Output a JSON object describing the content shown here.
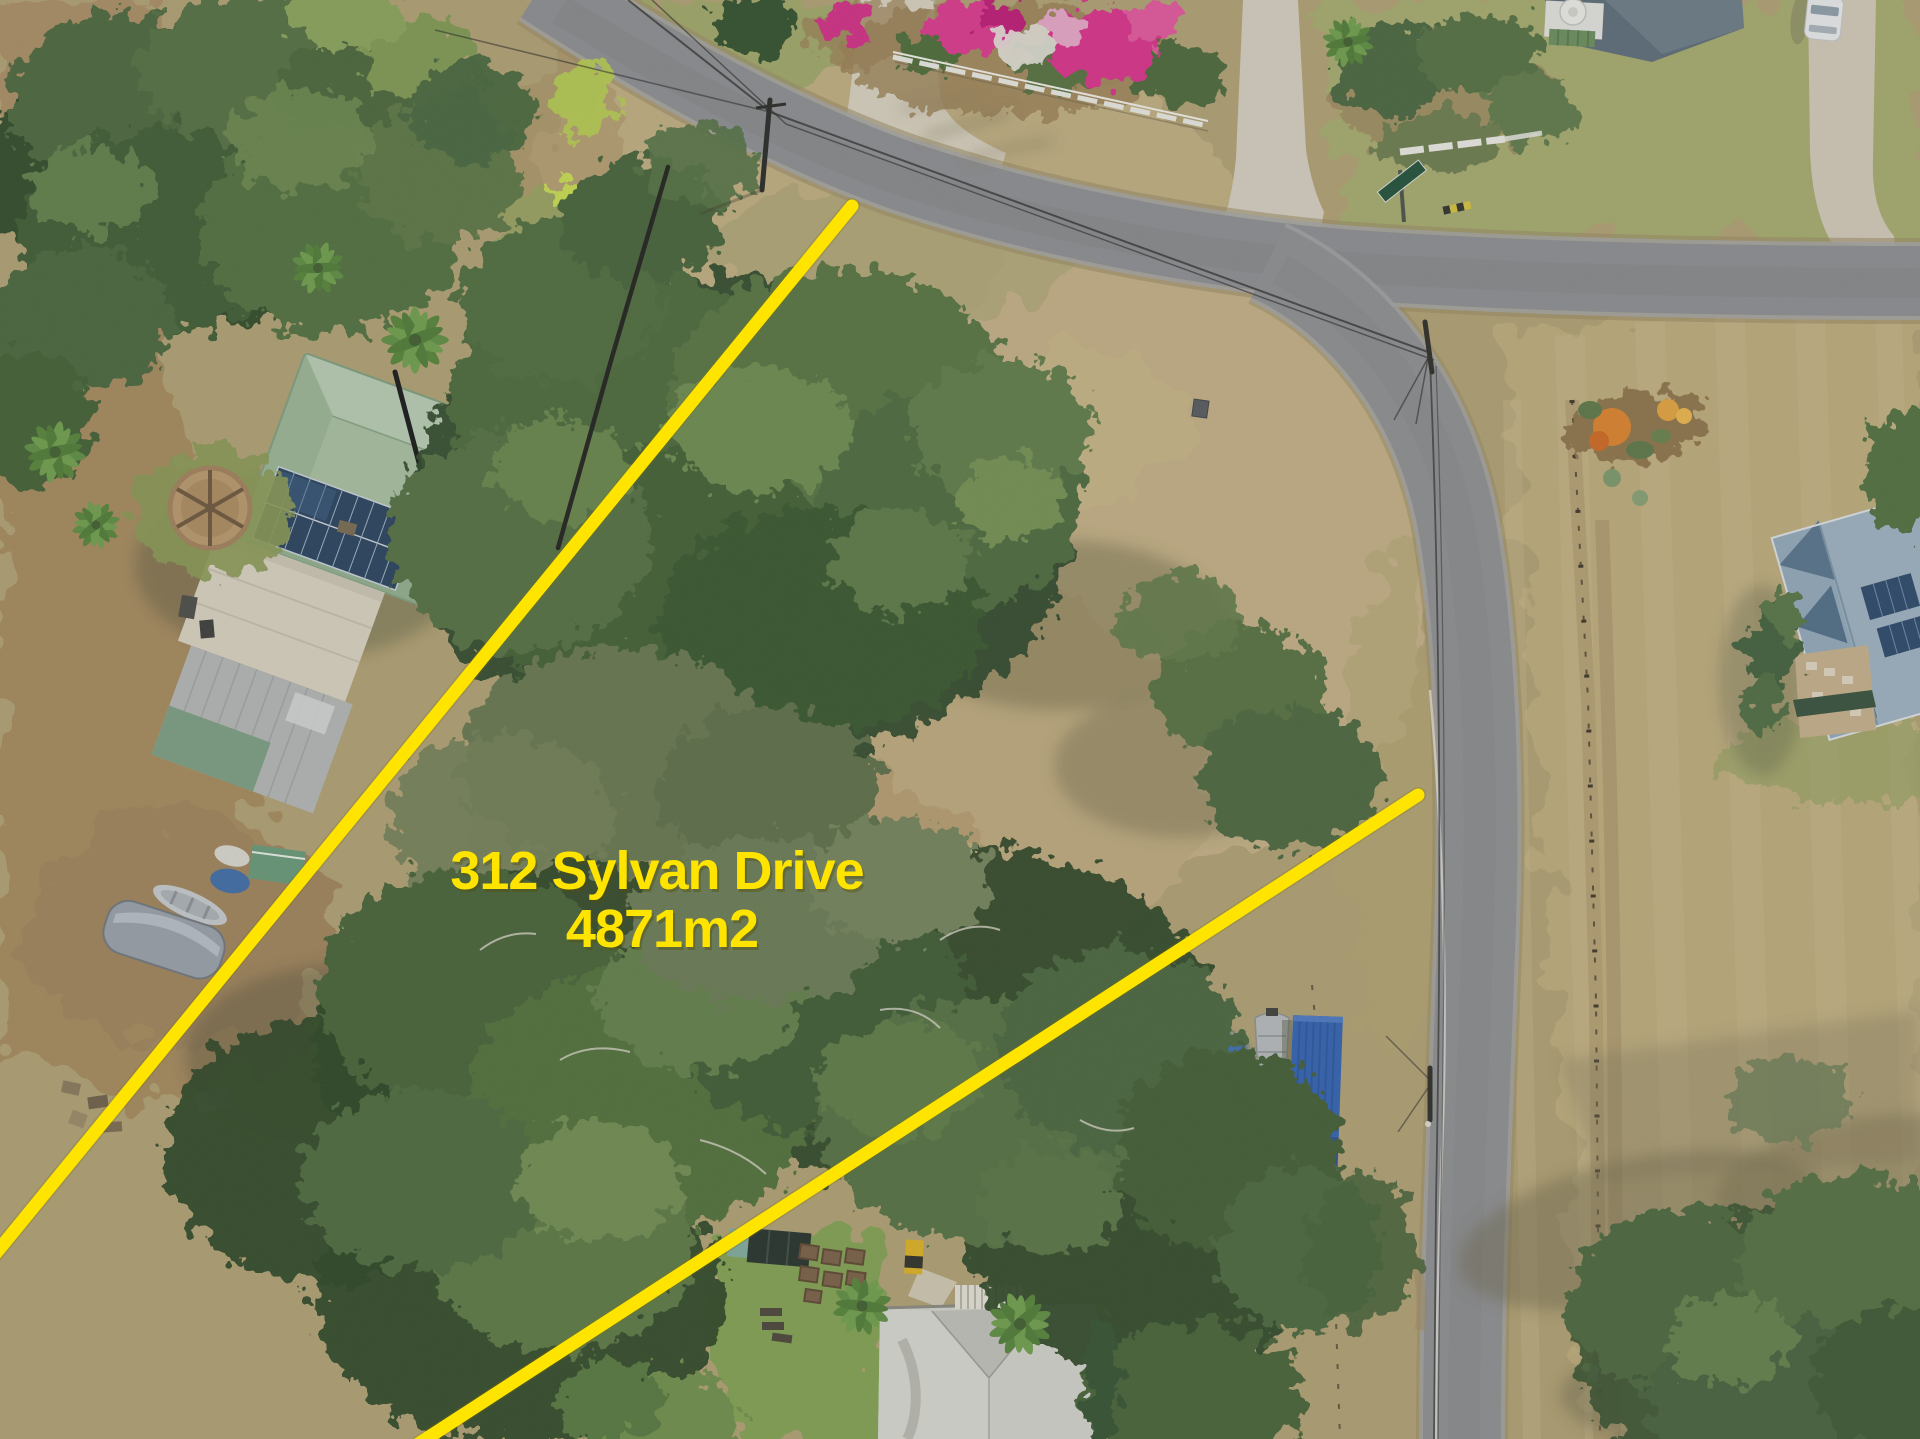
{
  "meta": {
    "kind": "aerial-drone-property-photo",
    "width": 1920,
    "height": 1439
  },
  "annotation": {
    "line1": "312 Sylvan Drive",
    "line2": "4871m2",
    "color": "#FFE400"
  },
  "scene": {
    "roads": {
      "main": "curved bitumen road (top)",
      "side": "straight bitumen side road (right)"
    },
    "colors": {
      "dry_grass": "#b3a272",
      "clearing": "#c4b183",
      "paddock": "#c0ae7c",
      "lawn_green": "#82a350",
      "road_grey": "#8e8f92",
      "concrete": "#dcd4c2",
      "canopy_dark": "#2c4726",
      "canopy_mid": "#4b6a3a",
      "canopy_light": "#6d8c4e",
      "green_roof": "#a9c2a2",
      "blue_roof": "#93abbd",
      "grey_roof": "#d5d5d0",
      "dark_roof": "#5b6c79",
      "solar_panel": "#24405d",
      "bougainvillea_pink": "#e0368f",
      "flower_orange": "#e08428",
      "container_blue": "#2f62b5",
      "boat_cover_grey": "#9aa2ab",
      "fence_white": "#eeede6"
    },
    "objects": [
      "green-roof house with solar panels",
      "carport roof",
      "grey shed",
      "paved fire-pit circle",
      "covered boat",
      "aluminium dinghy",
      "boat on trailer",
      "blue shipping container",
      "blue tarp",
      "white post-and-rail fence",
      "bougainvillea garden",
      "concrete driveways",
      "white car",
      "power poles and wires",
      "street-name sign",
      "dark-roof house (top)",
      "blue-roof house with solar panels (right)",
      "grey-roof house with pergola (bottom)",
      "raised garden beds",
      "paddock wire fence",
      "corner flower bed"
    ]
  }
}
